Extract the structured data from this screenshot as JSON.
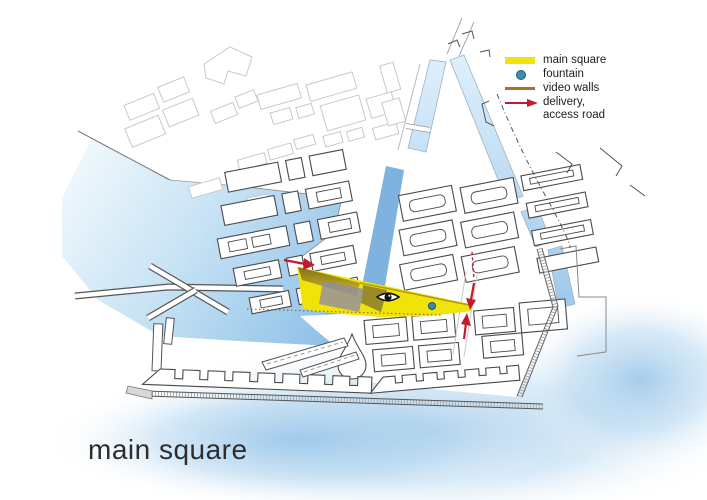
{
  "page_title": "main square",
  "legend": {
    "items": [
      {
        "label": "main square",
        "swatch": "bar"
      },
      {
        "label": "fountain",
        "swatch": "dot"
      },
      {
        "label": "video walls",
        "swatch": "line"
      },
      {
        "label": "delivery,\naccess road",
        "swatch": "arrow"
      }
    ]
  },
  "colors": {
    "square_yellow": "#f0e309",
    "video_wall_brown": "#a3762a",
    "delivery_red": "#c21b2b",
    "fountain_blue": "#3690b4",
    "overlay_purple": "#8f89a6",
    "canal_blue": "#7fb2de",
    "water_deep": "#85bbe6",
    "water_light": "#d8ebf8",
    "outline_dark": "#4a4a4a",
    "outline_faint": "#c9c9c9",
    "title_gray": "#2d2d2d",
    "legend_text": "#1d1d1d"
  }
}
